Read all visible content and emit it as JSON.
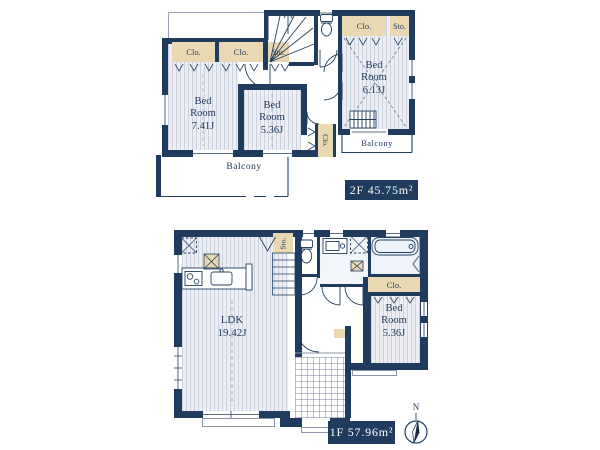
{
  "colors": {
    "background": "#ffffff",
    "wall_navy": "#1f3c5e",
    "closet_tan": "#ead8b2",
    "floor_gray": "#eceef3",
    "text_navy": "#22395c",
    "badge_navy": "#1f3c5e"
  },
  "floor2": {
    "area_label": "2F 45.75m²",
    "bedroom_741": "Bed\nRoom\n7.41J",
    "bedroom_536": "Bed\nRoom\n5.36J",
    "bedroom_613": "Bed\nRoom\n6.13J",
    "balcony_main": "Balcony",
    "balcony_side": "Balcony",
    "closet_left_1": "Clo.",
    "closet_left_2": "Clo.",
    "storage_stairs": "Sto.",
    "closet_right": "Clo.",
    "storage_right": "Sto.",
    "closet_mid_vertical": "Clo."
  },
  "floor1": {
    "area_label": "1F 57.96m²",
    "ldk": "LDK\n19.42J",
    "bedroom_536": "Bed\nRoom\n5.36J",
    "closet": "Clo.",
    "storage_under_stairs": "Sto.",
    "compass_north": "N"
  },
  "icons": [
    "toilet-icon",
    "bathtub-icon",
    "washbasin-icon",
    "kitchen-stove-icon",
    "kitchen-sink-icon",
    "refrigerator-space-icon",
    "washer-space-icon",
    "stairs-icon",
    "compass-icon",
    "door-swing-icon",
    "window-icon"
  ]
}
